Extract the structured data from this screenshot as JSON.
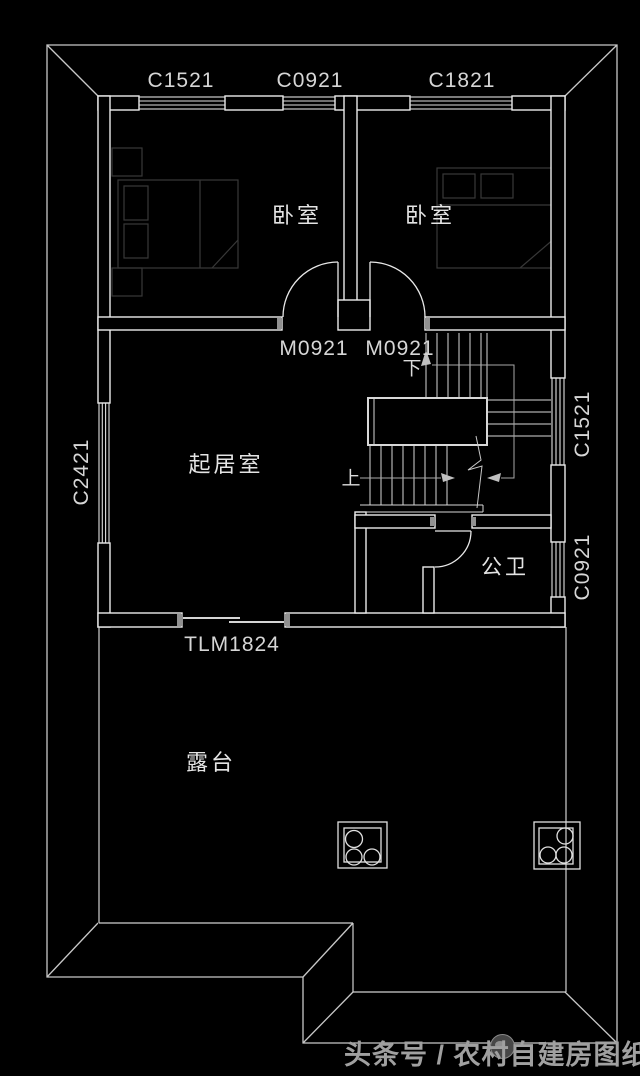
{
  "labels": {
    "windows_top": [
      "C1521",
      "C0921",
      "C1821"
    ],
    "windows_left": [
      "C2421"
    ],
    "windows_right": [
      "C1521",
      "C0921"
    ],
    "doors": {
      "bedroom_left": "M0921",
      "bedroom_right": "M0921",
      "terrace_slider": "TLM1824"
    },
    "rooms": {
      "bedroom_left": "卧室",
      "bedroom_right": "卧室",
      "living_room": "起居室",
      "bathroom": "公卫",
      "terrace": "露台"
    },
    "stairs": {
      "up": "上",
      "down": "下"
    }
  },
  "watermark": {
    "text": "头条号 / 农村自建房图纸"
  },
  "colors": {
    "background": "#000000",
    "wall_line": "#ececec",
    "roof_line": "#c8c8c8",
    "label": "#dcdcdc",
    "furniture": "#383838",
    "watermark": "#a0a0a0"
  }
}
